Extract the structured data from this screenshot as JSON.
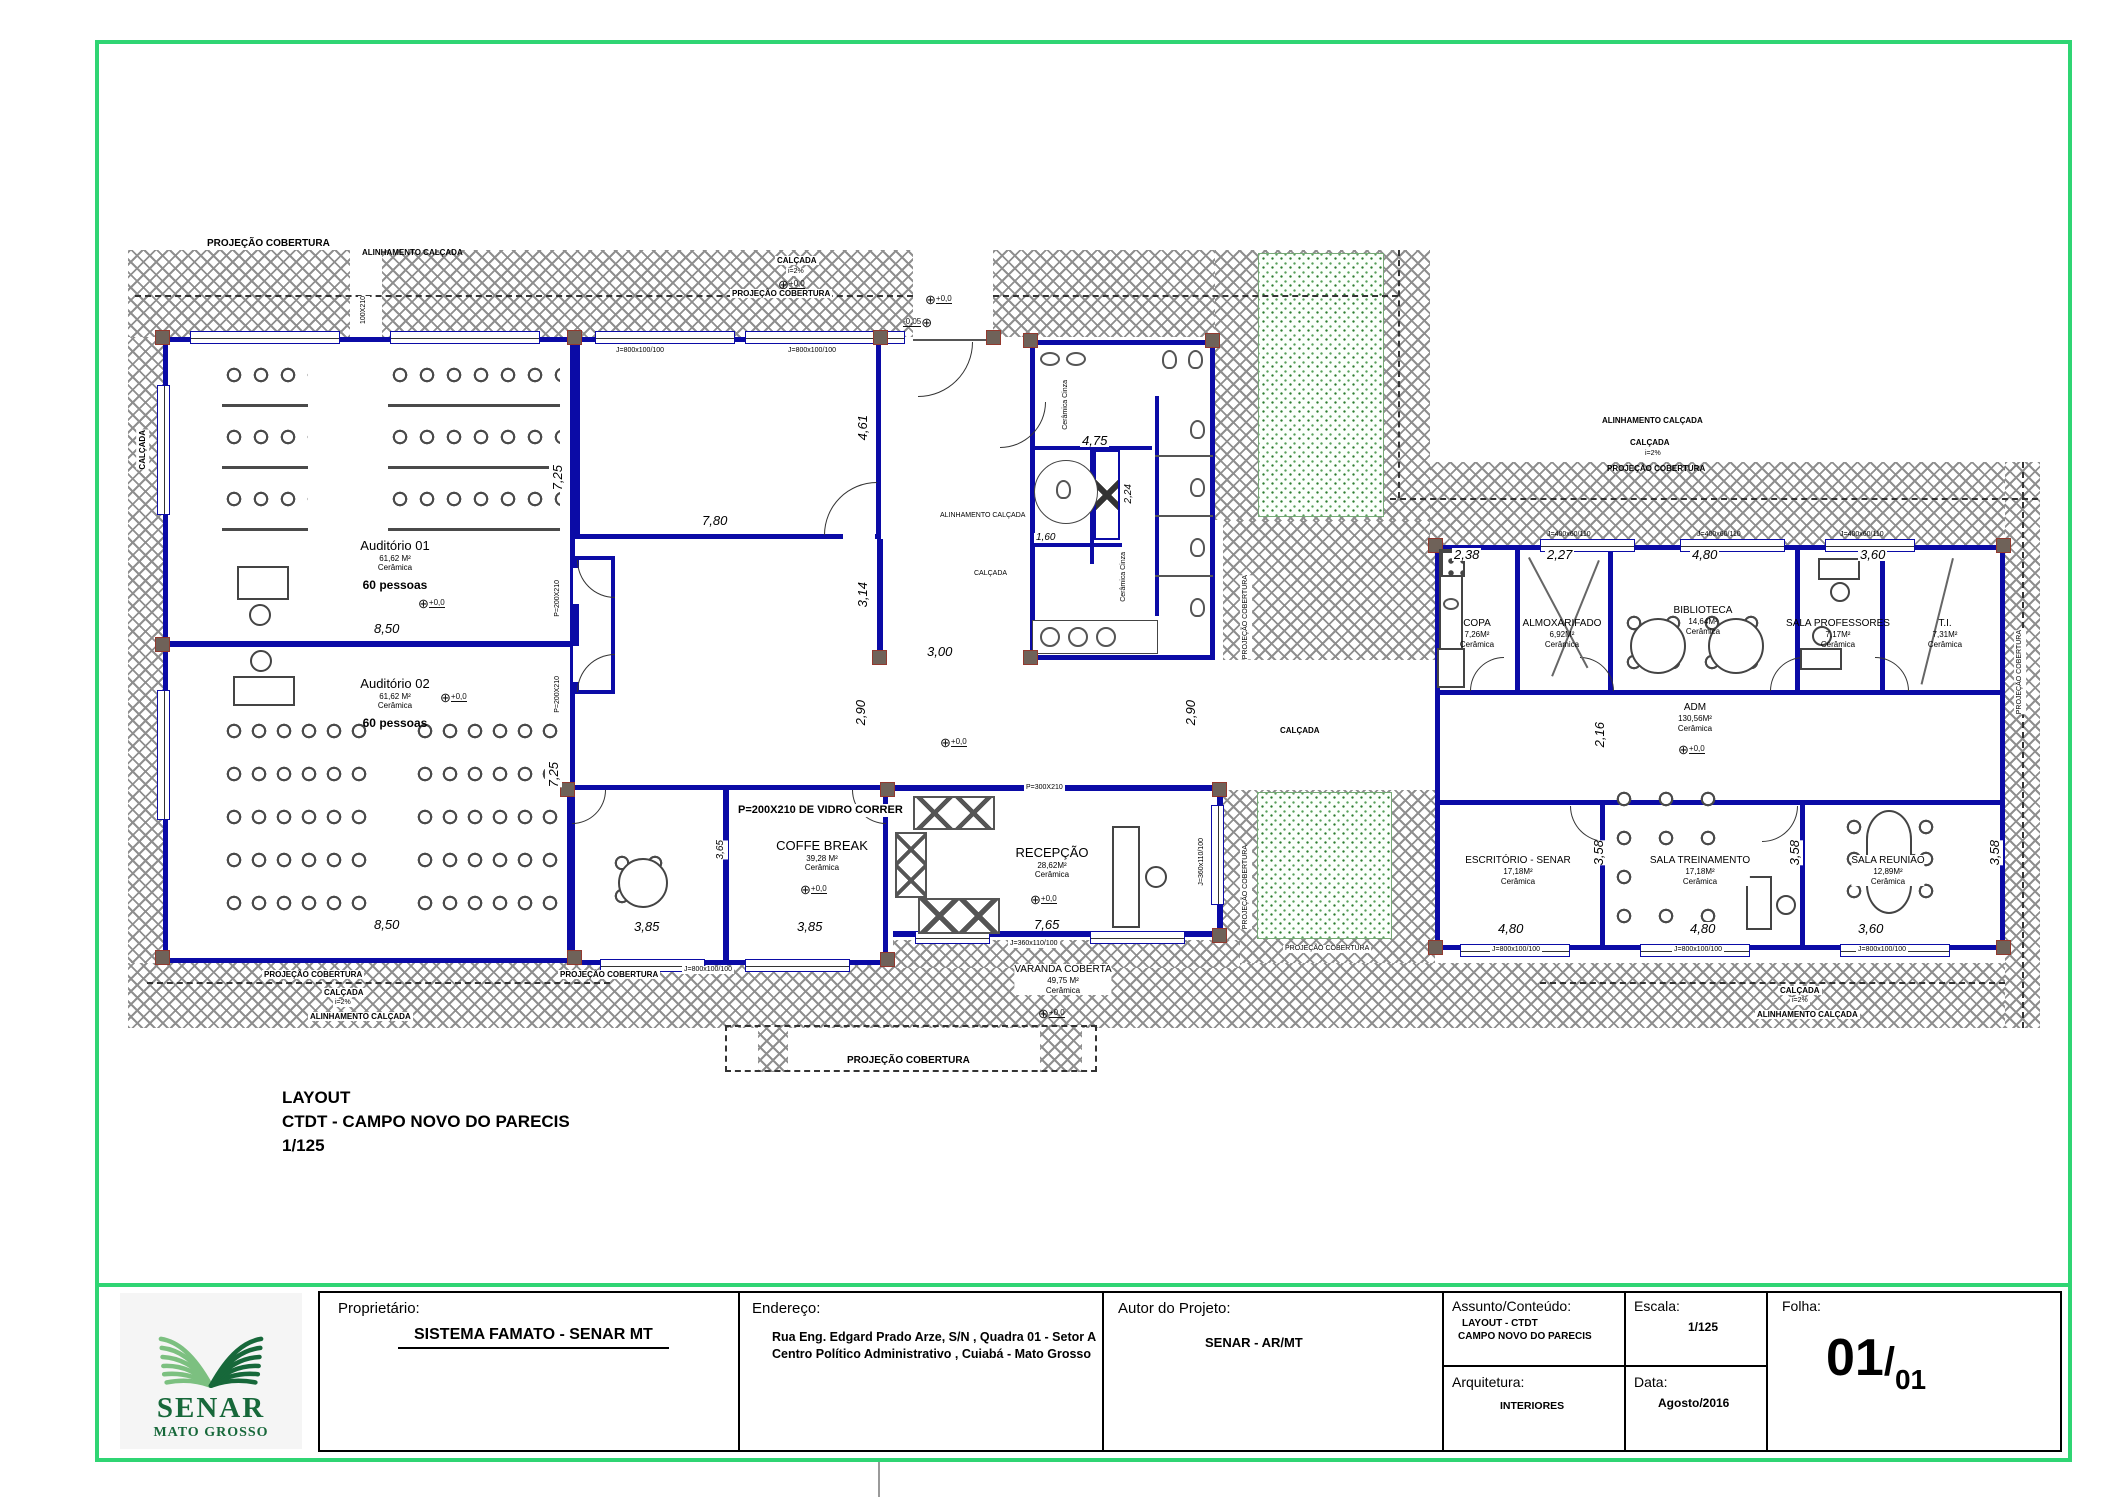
{
  "heading": {
    "l1": "LAYOUT",
    "l2": "CTDT - CAMPO NOVO DO PARECIS",
    "l3": "1/125"
  },
  "site": {
    "projecao": "PROJEÇÃO COBERTURA",
    "alinhamento": "ALINHAMENTO CALÇADA",
    "calcada": "CALÇADA",
    "slope": "i=2%",
    "level_icon": "⊕",
    "lvl0": "+0,0",
    "lvlm": "-0,05",
    "varanda": {
      "name": "VARANDA COBERTA",
      "area": "49,75 M²",
      "floor": "Cerâmica"
    }
  },
  "rooms": {
    "aud1": {
      "name": "Auditório 01",
      "area": "61,62 M²",
      "floor": "Cerâmica",
      "cap": "60 pessoas"
    },
    "aud2": {
      "name": "Auditório 02",
      "area": "61,62 M²",
      "floor": "Cerâmica",
      "cap": "60 pessoas"
    },
    "wc_note": "Cerâmica Cinza",
    "copa": {
      "name": "COPA",
      "area": "7,26M²",
      "floor": "Cerâmica"
    },
    "almox": {
      "name": "ALMOXARIFADO",
      "area": "6,92M²",
      "floor": "Cerâmica"
    },
    "biblio": {
      "name": "BIBLIOTECA",
      "area": "14,64M²",
      "floor": "Cerâmica"
    },
    "prof": {
      "name": "SALA PROFESSORES",
      "area": "7,17M²",
      "floor": "Cerâmica"
    },
    "ti": {
      "name": "T.I.",
      "area": "7,31M²",
      "floor": "Cerâmica"
    },
    "adm": {
      "name": "ADM",
      "area": "130,56M²",
      "floor": "Cerâmica"
    },
    "escr": {
      "name": "ESCRITÓRIO - SENAR",
      "area": "17,18M²",
      "floor": "Cerâmica"
    },
    "trein": {
      "name": "SALA TREINAMENTO",
      "area": "17,18M²",
      "floor": "Cerâmica"
    },
    "reun": {
      "name": "SALA REUNIÃO",
      "area": "12,89M²",
      "floor": "Cerâmica"
    },
    "coffe": {
      "name": "COFFE BREAK",
      "area": "39,28 M²",
      "floor": "Cerâmica"
    },
    "recep": {
      "name": "RECEPÇÃO",
      "area": "28,62M²",
      "floor": "Cerâmica"
    }
  },
  "dims": {
    "a1w": "8,50",
    "a1h": "7,25",
    "a2w": "8,50",
    "a2h": "7,25",
    "hallw": "7,80",
    "hallh1": "4,61",
    "hallh2": "3,14",
    "gap": "3,00",
    "corr": "2,90",
    "wcw": "4,75",
    "wcd": "1,60",
    "wch": "2,24",
    "copaw": "2,38",
    "almoxw": "2,27",
    "bibw": "4,80",
    "tiw": "3,60",
    "admh": "2,16",
    "escrw": "4,80",
    "treinw": "4,80",
    "reunw": "3,60",
    "rowh": "3,58",
    "cofw1": "3,85",
    "cofw2": "3,85",
    "cofh": "3,65",
    "recw": "7,65"
  },
  "openings": {
    "p200": "P=200X210",
    "p100": "100X210",
    "p300": "P=300X210",
    "pglass": "P=200X210 DE VIDRO CORRER",
    "j800": "J=800x100/100",
    "j360": "J=360x110/100",
    "j400": "J=400x60/110"
  },
  "titleblock": {
    "logo": {
      "name": "SENAR",
      "sub": "MATO GROSSO"
    },
    "prop_label": "Proprietário:",
    "prop_value": "SISTEMA FAMATO - SENAR MT",
    "end_label": "Endereço:",
    "end_l1": "Rua Eng. Edgard Prado Arze, S/N , Quadra 01 - Setor A",
    "end_l2": "Centro Político Administrativo , Cuiabá - Mato Grosso",
    "autor_label": "Autor do Projeto:",
    "autor_value": "SENAR - AR/MT",
    "assunto_label": "Assunto/Conteúdo:",
    "assunto_l1": "LAYOUT - CTDT",
    "assunto_l2": "CAMPO NOVO DO PARECIS",
    "escala_label": "Escala:",
    "escala_value": "1/125",
    "arq_label": "Arquitetura:",
    "arq_value": "INTERIORES",
    "data_label": "Data:",
    "data_value": "Agosto/2016",
    "folha_label": "Folha:",
    "folha_num": "01",
    "folha_sep": "/",
    "folha_den": "01"
  },
  "colors": {
    "wall": "#0b0ba6",
    "frame": "#2fd573",
    "logo_green": "#17683a",
    "grass_dot": "#2f7d32"
  }
}
